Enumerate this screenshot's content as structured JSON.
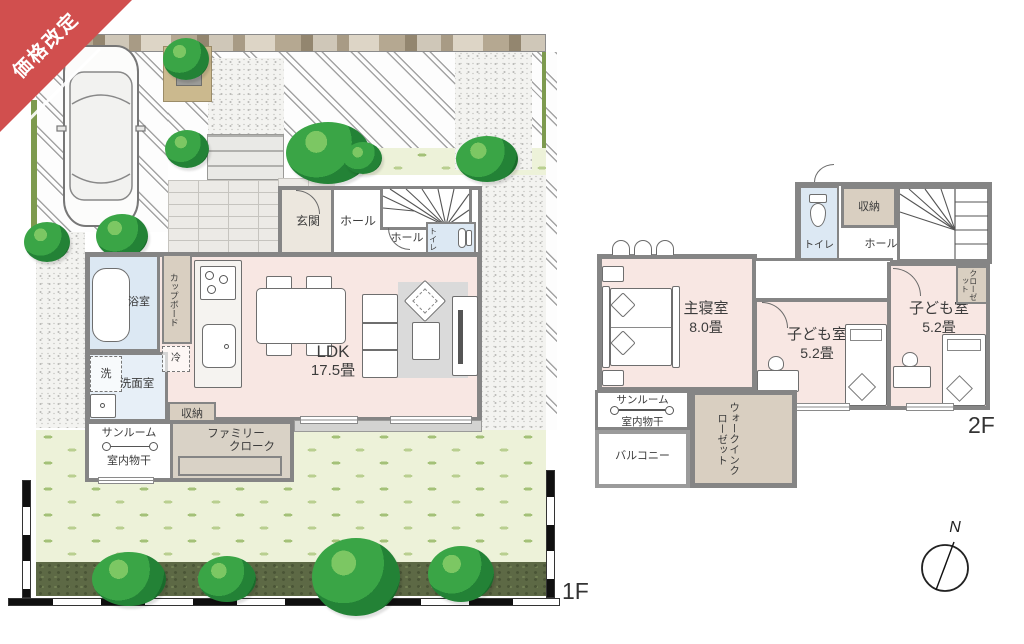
{
  "ribbon": {
    "label": "価格改定",
    "color": "#d14f4e"
  },
  "floor1": {
    "floor_label": "1F",
    "rooms": {
      "genkan": "玄関",
      "hall_upper": "ホール",
      "hall_lower": "ホール",
      "toilet": "トイレ",
      "bath": "浴室",
      "washer": "洗",
      "washroom": "洗面室",
      "cupboard": "カップボード",
      "fridge": "冷",
      "storage": "収納",
      "ldk_name": "LDK",
      "ldk_size": "17.5畳",
      "sunroom": "サンルーム",
      "drying": "室内物干",
      "family_cloak_line1": "ファミリー",
      "family_cloak_line2": "クローク"
    }
  },
  "floor2": {
    "floor_label": "2F",
    "rooms": {
      "master": "主寝室",
      "master_size": "8.0畳",
      "closet_small": "クローゼット",
      "kids_center": "子ども室",
      "kids_center_size": "5.2畳",
      "kids_right": "子ども室",
      "kids_right_size": "5.2畳",
      "closet_right": "クローゼット",
      "wic": "ウォークインクローゼット",
      "sunroom": "サンルーム",
      "drying": "室内物干",
      "balcony": "バルコニー",
      "toilet": "トイレ",
      "storage": "収納",
      "hall": "ホール"
    }
  },
  "compass": {
    "north_label": "N"
  },
  "colors": {
    "room_pink": "#f8e7e3",
    "wet_blue": "#dce8f3",
    "closet_beige": "#d9cfc1",
    "wall_gray": "#858585",
    "lawn_green": "#edf2d9",
    "hedge_green": "#5d6945",
    "tree_green": "#3aa546",
    "ribbon_red": "#d14f4e"
  }
}
